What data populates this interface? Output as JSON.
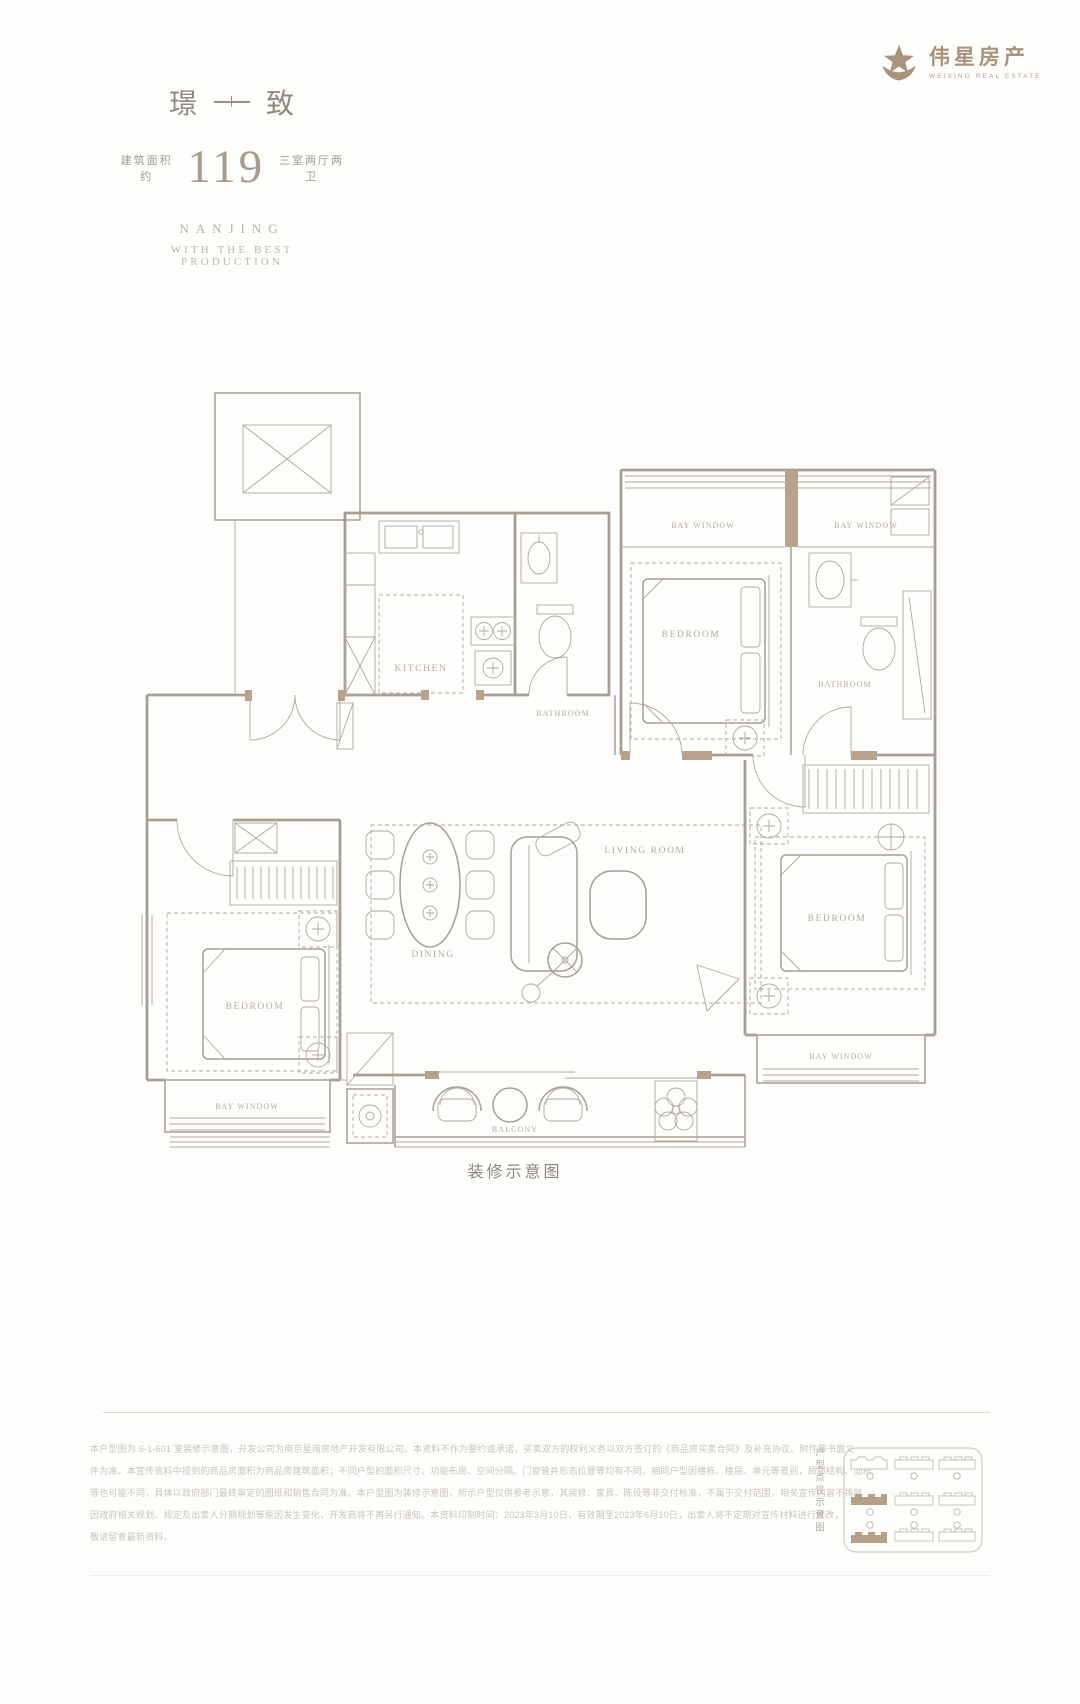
{
  "brand": {
    "name": "伟星房产",
    "name_en": "WEIXING REAL ESTATE"
  },
  "header": {
    "title_char_left": "璟",
    "title_char_right": "致",
    "area_label": "建筑面积约",
    "area_value": "119",
    "rooms_label": "三室两厅两卫",
    "tagline_city": "NANJING",
    "tagline_text": "WITH THE BEST PRODUCTION"
  },
  "floorplan": {
    "labels": {
      "kitchen": "KITCHEN",
      "bathroom": "BATHROOM",
      "bedroom": "BEDROOM",
      "living_room": "LIVING ROOM",
      "dining": "DINING",
      "bay_window": "BAY WINDOW",
      "balcony": "BALCONY"
    },
    "caption": "装修示意图"
  },
  "footer": {
    "disclaimer_lines": [
      "本户型图为 6-1-601 室装修示意图，开发公司为南京星雨房地产开发有限公司。本资料不作为要约或承诺，买卖双方的权利义务以双方签订的《商品房买卖合同》及补充协议、附件等书面文",
      "件为准。本宣传资料中提到的商品房面积为商品房建筑面积；不同户型的面积尺寸、功能布局、空间分隔、门窗管井形态位置等均有不同，相同户型因楼栋、楼层、单元等差别，局部结构、面积",
      "等也可能不同，具体以政府部门最终审定的图纸和销售合同为准。本户型图为装修示意图，所示户型仅供参考示意，其装修、家具、陈设等非交付标准，不属于交付范围，相关宣传内容不排除",
      "因政府相关规划、规定及出卖人分期规划等原因发生变化，开发商将不再另行通知。本资料印制时间：2023年3月10日，有效期至2023年6月10日，出卖人将不定期对宣传材料进行修改，",
      "敬请留意最新资料。"
    ],
    "keyplan_label": "户型点位示意图"
  },
  "colors": {
    "accent": "#a8937c",
    "plan_line": "#a89e91",
    "room_label": "#b4aa9c",
    "muted_text": "#c9c4bb"
  }
}
